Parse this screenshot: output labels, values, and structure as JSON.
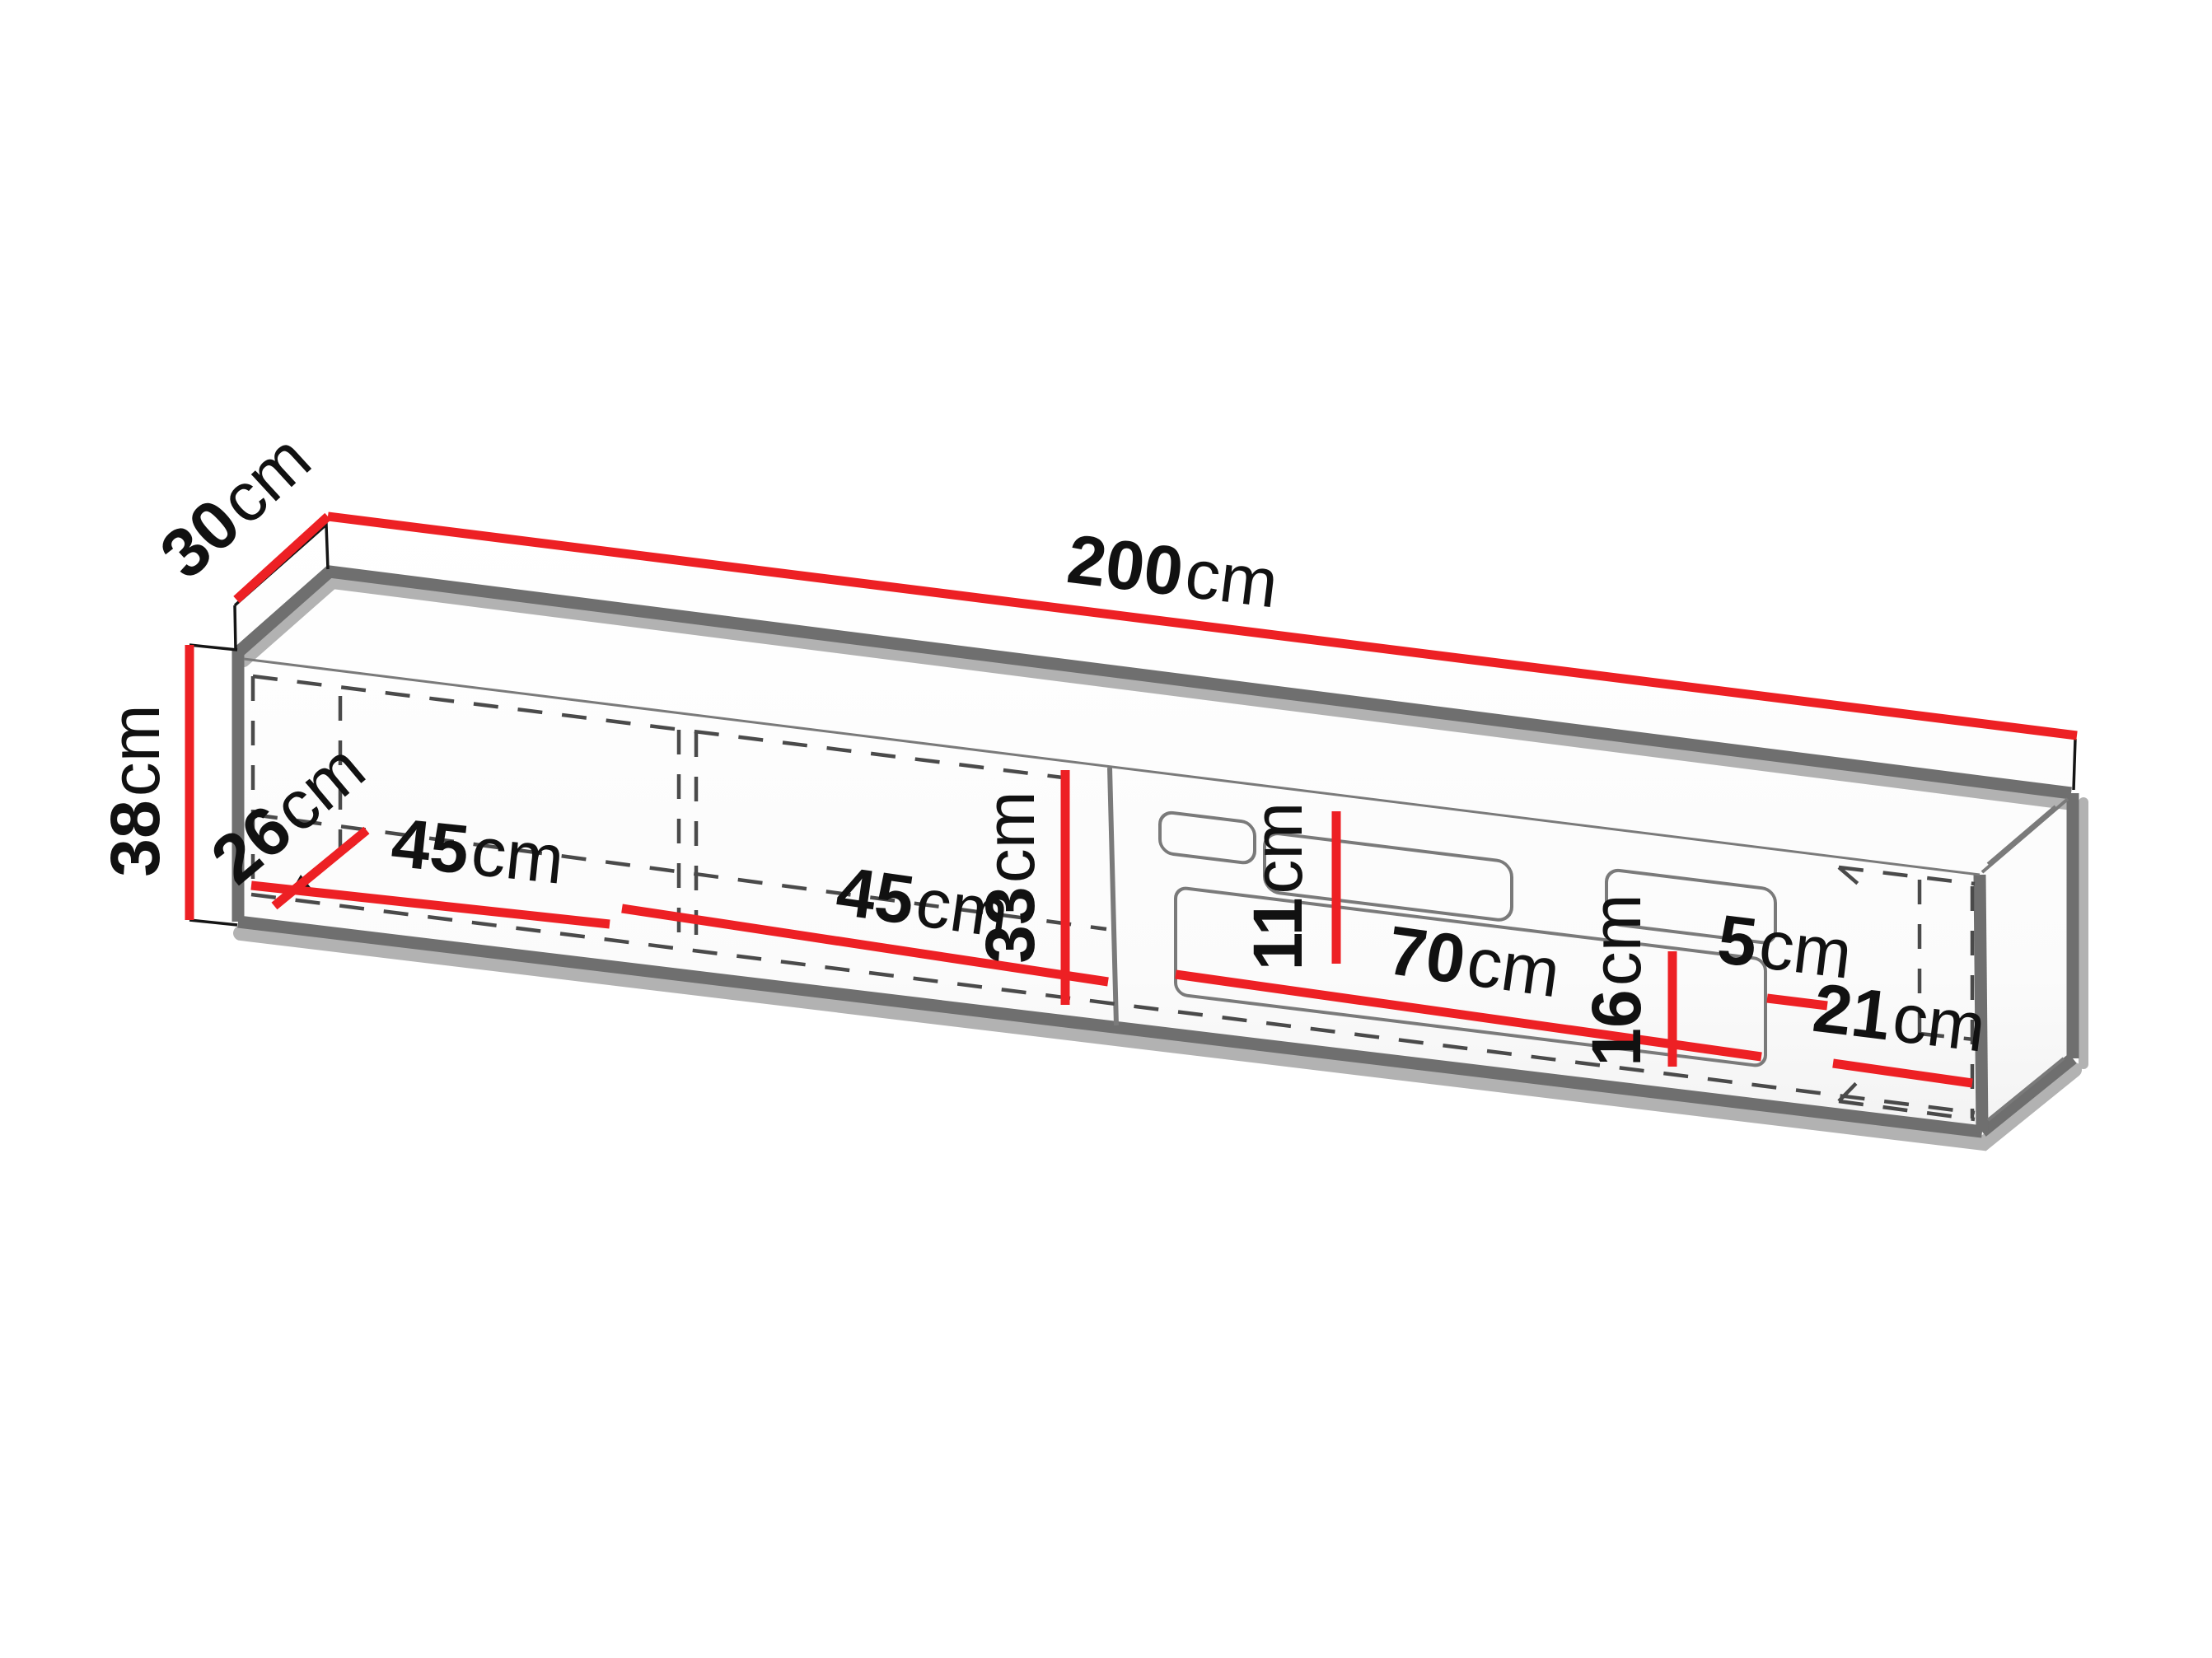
{
  "diagram": {
    "type": "furniture-dimension-diagram",
    "subject": "wall-mounted TV cabinet with open shelves and recessed fronts",
    "unit": "cm",
    "dimensions": {
      "depth": {
        "num": "30",
        "unit": "cm"
      },
      "width": {
        "num": "200",
        "unit": "cm"
      },
      "height": {
        "num": "38",
        "unit": "cm"
      },
      "inner_depth": {
        "num": "26",
        "unit": "cm"
      },
      "shelf1_width": {
        "num": "45",
        "unit": "cm"
      },
      "shelf2_width": {
        "num": "45",
        "unit": "cm"
      },
      "inner_height": {
        "num": "33",
        "unit": "cm"
      },
      "slot_height": {
        "num": "11",
        "unit": "cm"
      },
      "recess_width": {
        "num": "70",
        "unit": "cm"
      },
      "recess_height": {
        "num": "16",
        "unit": "cm"
      },
      "gap_width": {
        "num": "5",
        "unit": "cm"
      },
      "end_compartment_width": {
        "num": "21",
        "unit": "cm"
      }
    },
    "colors": {
      "dimension_line": "#ed2024",
      "edge": "#6f6f6f",
      "shadow": "#b2b2b2",
      "hidden_line": "#4a4a4a",
      "thin_line": "#3a3a3a",
      "label": "#111111",
      "background": "#ffffff"
    }
  }
}
